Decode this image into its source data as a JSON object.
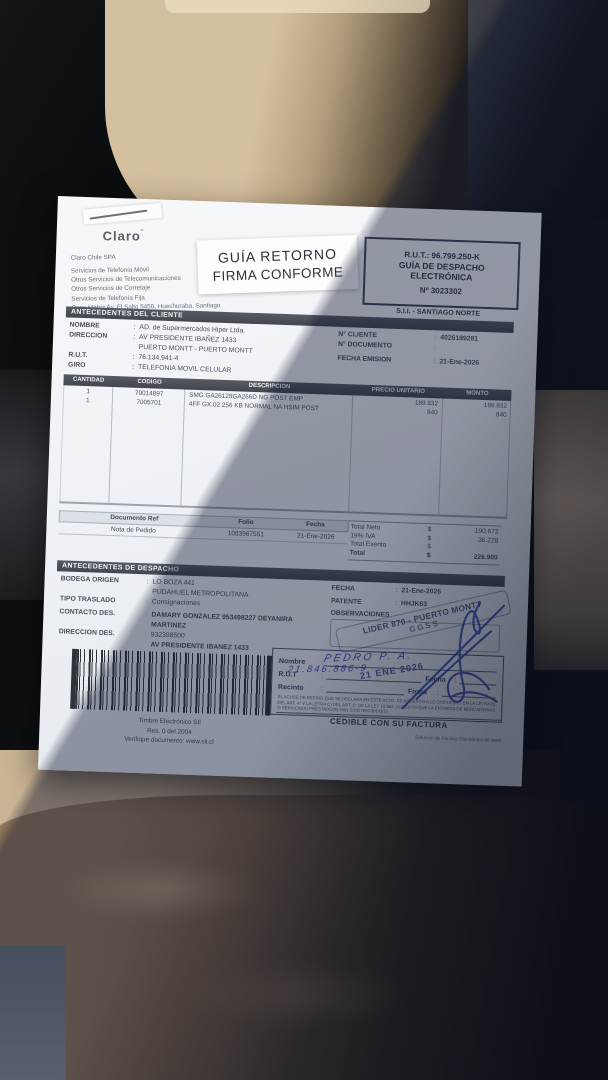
{
  "ui": {
    "colon": ":"
  },
  "colors": {
    "paper": "#f3f5f8",
    "ink": "#454c56",
    "header_bar": "#4b5058",
    "ink_stamp": "#33427a",
    "pen": "#2b3fae",
    "seat": "#c9b290",
    "coat": "#8a7154"
  },
  "document": {
    "logo": "Claro",
    "logo_mark": "˘",
    "supplier_lines": [
      "Claro Chile SPA",
      "Servicios de Telefonía Móvil",
      "Otros Servicios de Telecomunicaciones",
      "Otros Servicios de Corretaje",
      "Servicios de Telefonía Fija",
      "Casa Matriz Av. El Salto 5450, Huechuraba, Santiago"
    ],
    "return_sticker": {
      "line1": "GUÍA RETORNO",
      "line2": "FIRMA CONFORME"
    },
    "rut_box": {
      "rut_label": "R.U.T.:",
      "rut_value": "96.799.250-K",
      "type_line1": "GUÍA DE DESPACHO",
      "type_line2": "ELECTRÓNICA",
      "number": "Nº 3023302"
    },
    "sii_office": "S.I.I. - SANTIAGO NORTE",
    "client": {
      "title": "ANTECEDENTES DEL CLIENTE",
      "rows_left": [
        {
          "label": "NOMBRE",
          "value": "AD. de Supermercados Hiper Ltda."
        },
        {
          "label": "DIRECCION",
          "value": "AV PRESIDENTE IBAÑEZ 1433"
        },
        {
          "label": "",
          "value": "PUERTO MONTT -  PUERTO MONTT"
        },
        {
          "label": "R.U.T.",
          "value": "76.134.941-4"
        },
        {
          "label": "GIRO",
          "value": "TELEFONIA MOVIL CELULAR"
        }
      ],
      "rows_right": [
        {
          "label": "N° CLIENTE",
          "value": "4026189281"
        },
        {
          "label": "N° DOCUMENTO",
          "value": ""
        },
        {
          "label": "FECHA EMISION",
          "value": "21-Ene-2026"
        }
      ]
    },
    "items": {
      "headers": [
        "CANTIDAD",
        "CODIGO",
        "DESCRIPCION",
        "PRECIO UNITARIO",
        "MONTO"
      ],
      "rows": [
        {
          "cantidad": "1",
          "codigo": "70014897",
          "descripcion": "SMG GA26128GA266D NG POST EMP",
          "precio": "189.832",
          "monto": "189.832"
        },
        {
          "cantidad": "1",
          "codigo": "7005701",
          "descripcion": "4FF GX.02 256 KB NORMAL NA HSIM POST",
          "precio": "840",
          "monto": "840"
        }
      ]
    },
    "refs": {
      "headers": [
        "Documento Ref",
        "Folio",
        "Fecha"
      ],
      "row": {
        "doc": "Nota de Pedido",
        "folio": "1083967551",
        "fecha": "21-Ene-2026"
      }
    },
    "totals": {
      "currency": "$",
      "rows": [
        {
          "label": "Total Neto",
          "value": "190.672"
        },
        {
          "label": "19% IVA",
          "value": "36.228"
        },
        {
          "label": "Total Exento",
          "value": ""
        },
        {
          "label": "Total",
          "value": "226.900"
        }
      ]
    },
    "dispatch": {
      "title": "ANTECEDENTES DE DESPACHO",
      "rows_left": [
        {
          "label": "BODEGA ORIGEN",
          "value": "LO BOZA 441"
        },
        {
          "label": "",
          "value": "PUDAHUEL   METROPOLITANA"
        },
        {
          "label": "TIPO TRASLADO",
          "value": "Consignaciones"
        },
        {
          "label": "CONTACTO DES.",
          "value": "DAMARY GONZALEZ 953498227 DEYANIRA MARTINEZ"
        },
        {
          "label": "DIRECCION DES.",
          "value": "932398500"
        },
        {
          "label": "",
          "value": "AV PRESIDENTE IBANEZ 1433"
        },
        {
          "label": "",
          "value": "PUERTO MONTT   PUERTO MONTT"
        }
      ],
      "rows_right": [
        {
          "label": "FECHA",
          "value": "21-Ene-2026"
        },
        {
          "label": "PATENTE",
          "value": "HHJK63"
        }
      ],
      "observaciones_label": "OBSERVACIONES"
    },
    "ink_stamp": {
      "line1": "LIDER 870 - PUERTO MONTT",
      "line2": "GGSS",
      "date": "21 ENE 2026"
    },
    "receipt": {
      "nombre_label": "Nombre",
      "rut_label": "R.U.T",
      "recinto_label": "Recinto",
      "fecha_label": "Fecha",
      "firma_label": "Firma",
      "nombre_hand": "PEDRO P. A.",
      "rut_hand": "21.846.886-9",
      "fine_print": "EL ACUSE DE RECIBO QUE SE DECLARA EN ESTE ACTO, DE ACUERDO A LO DISPUESTO EN LA LETRA B) DEL ART. 4° Y LA LETRA C) DEL ART. 5° DE LA LEY 19.983, ACREDITA QUE LA ENTREGA DE MERCADERIAS O SERVICIO(S) PRESTADO(S) HAN SIDO RECIBIDO(S).",
      "cedible": "CEDIBLE CON SU FACTURA"
    },
    "timbre": {
      "line1": "Timbre Electrónico SII",
      "line2": "Res. 0 del 2004",
      "line3": "Verifique documento: www.sii.cl"
    },
    "footer_right": "Solución de Factura Electrónica de www"
  }
}
